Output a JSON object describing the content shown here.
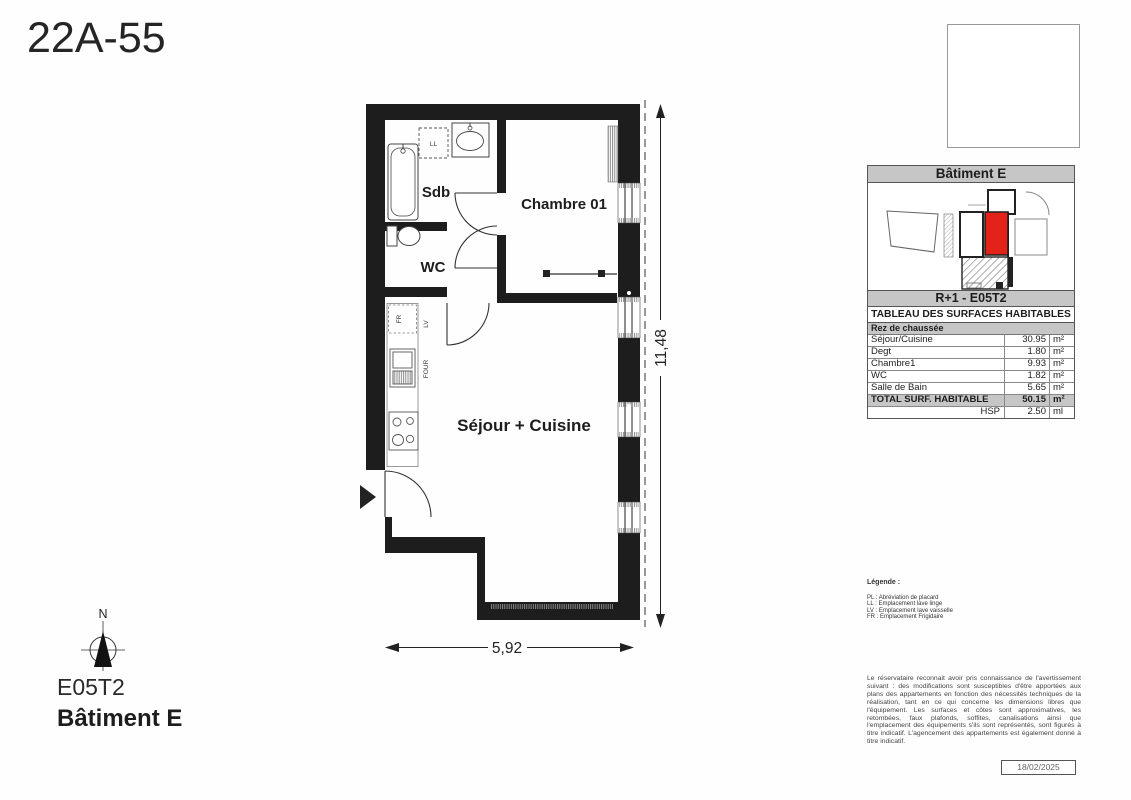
{
  "title": "22A-55",
  "unit": {
    "code": "E05T2",
    "building": "Bâtiment E"
  },
  "compass": {
    "north_label": "N"
  },
  "plan": {
    "rooms": {
      "sdb": "Sdb",
      "wc": "WC",
      "chambre": "Chambre 01",
      "sejour": "Séjour + Cuisine"
    },
    "appliances": {
      "ll": "LL",
      "lv": "LV",
      "fr": "FR",
      "four": "FOUR"
    },
    "dimensions": {
      "height": "11,48",
      "width": "5,92"
    }
  },
  "panel": {
    "building_header": "Bâtiment E",
    "floor_unit": "R+1 - E05T2",
    "table_title": "TABLEAU DES SURFACES HABITABLES",
    "level_header": "Rez de chaussée",
    "rows": [
      {
        "label": "Séjour/Cuisine",
        "value": "30.95",
        "unit": "m²"
      },
      {
        "label": "Degt",
        "value": "1.80",
        "unit": "m²"
      },
      {
        "label": "Chambre1",
        "value": "9.93",
        "unit": "m²"
      },
      {
        "label": "WC",
        "value": "1.82",
        "unit": "m²"
      },
      {
        "label": "Salle de Bain",
        "value": "5.65",
        "unit": "m²"
      }
    ],
    "total": {
      "label": "TOTAL SURF. HABITABLE",
      "value": "50.15",
      "unit": "m²"
    },
    "hsp": {
      "label": "HSP",
      "value": "2.50",
      "unit": "ml"
    }
  },
  "legend": {
    "title": "Légende :",
    "items": [
      "PL : Abréviation de placard",
      "LL : Emplacement lave linge",
      "LV : Emplacement lave vaisselle",
      "FR : Emplacement Frigidaire"
    ]
  },
  "disclaimer": "Le réservataire reconnait avoir pris connaissance de l'avertissement suivant : des modifications sont susceptibles d'être apportées aux plans des appartements en fonction des nécessités techniques de la réalisation, tant en ce qui concerne les dimensions libres que l'équipement. Les surfaces et côtes sont approximatives, les retombées, faux plafonds, soffites, canalisations ainsi que l'emplacement des équipements s'ils sont représentés, sont figurés à titre indicatif. L'agencement des appartements est également donné à titre indicatif.",
  "date": "18/02/2025",
  "colors": {
    "highlight_red": "#e32219",
    "header_gray": "#c6c6c6",
    "wall_black": "#1d1d1d"
  }
}
